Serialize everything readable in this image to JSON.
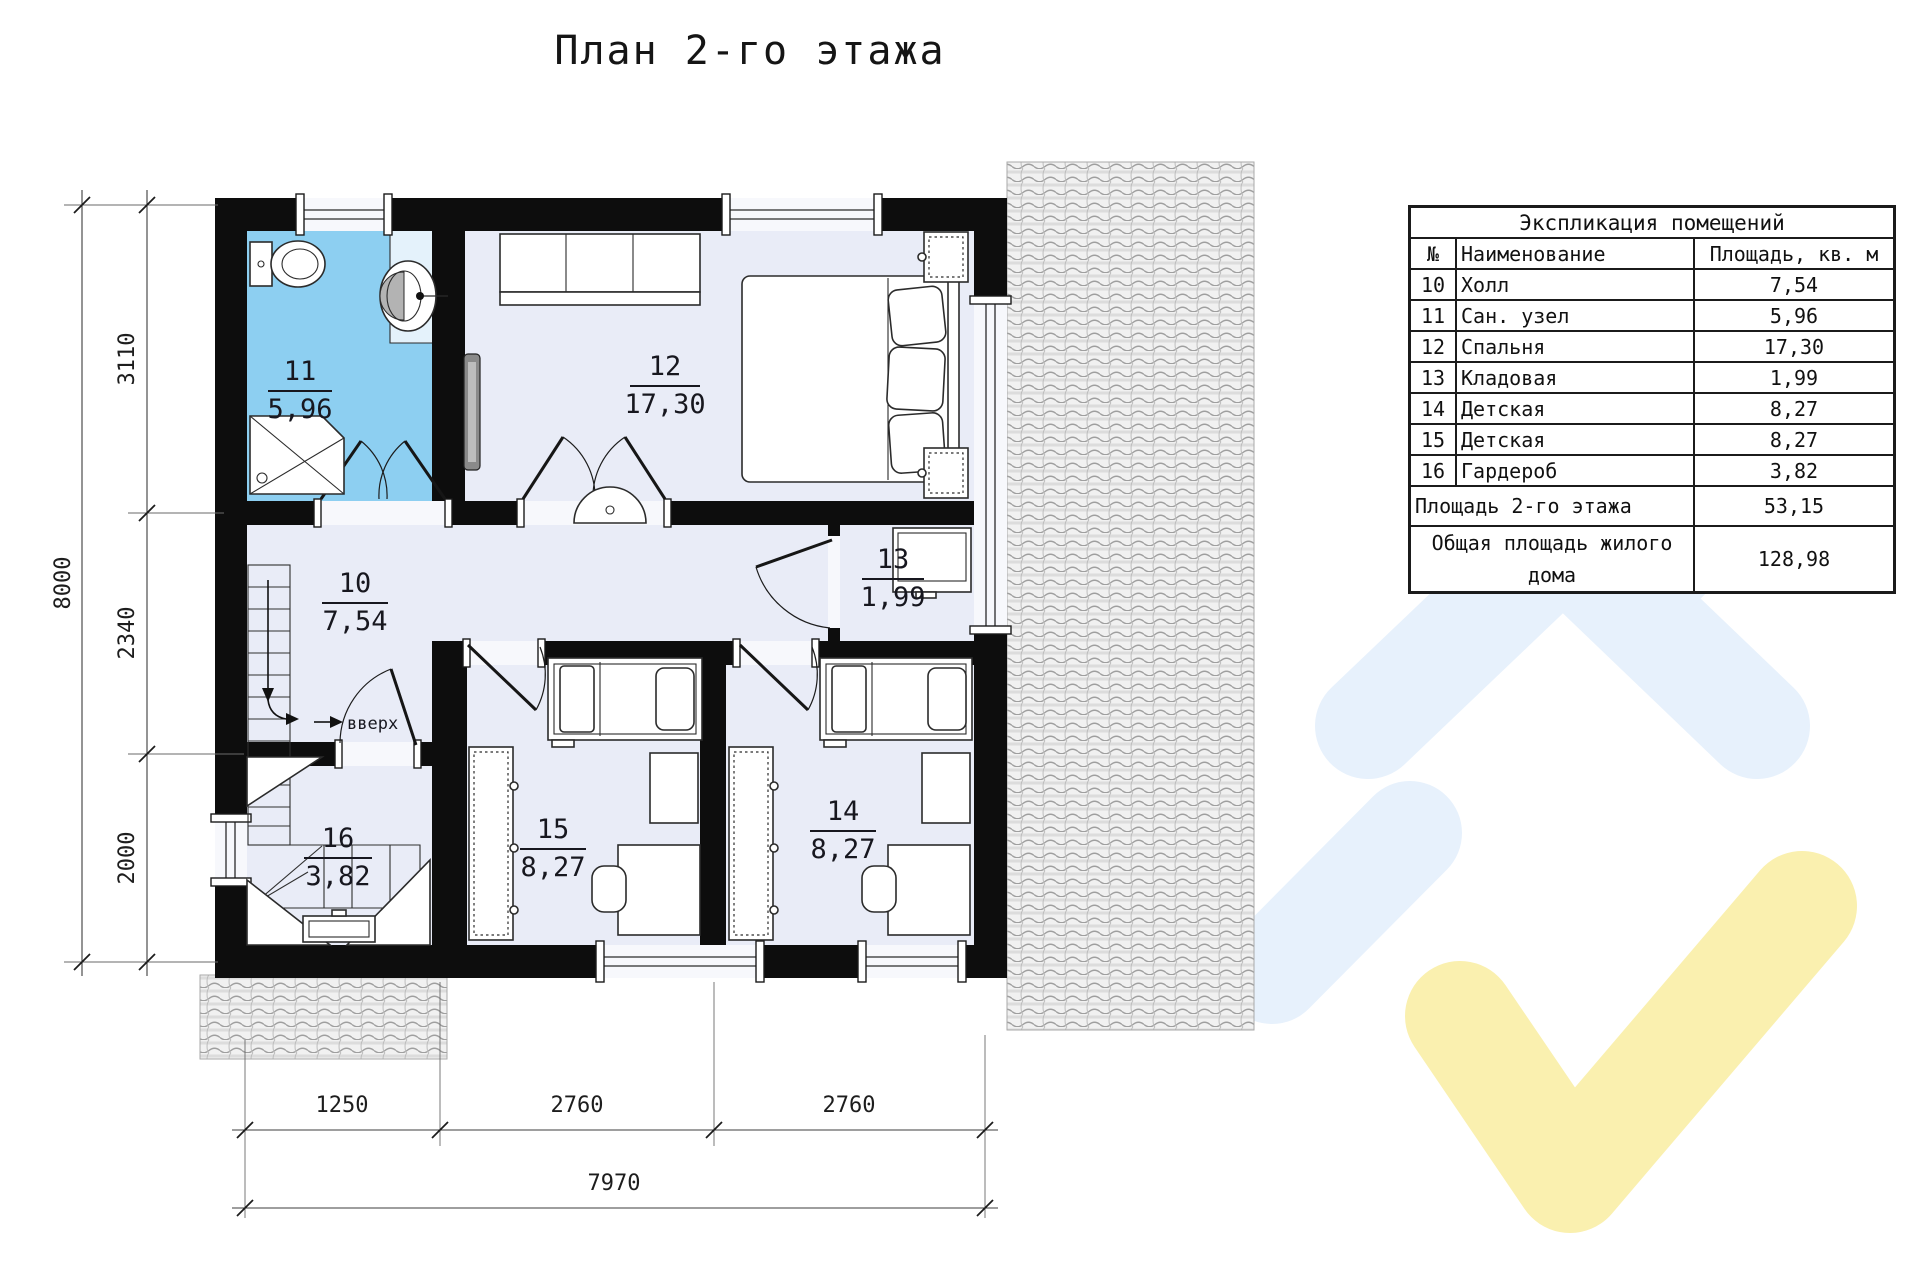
{
  "title": "План 2-го этажа",
  "plan": {
    "stairs_label": "вверх",
    "rooms": {
      "r10": {
        "num": "10",
        "area": "7,54"
      },
      "r11": {
        "num": "11",
        "area": "5,96"
      },
      "r12": {
        "num": "12",
        "area": "17,30"
      },
      "r13": {
        "num": "13",
        "area": "1,99"
      },
      "r14": {
        "num": "14",
        "area": "8,27"
      },
      "r15": {
        "num": "15",
        "area": "8,27"
      },
      "r16": {
        "num": "16",
        "area": "3,82"
      }
    }
  },
  "dimensions": {
    "left_total": "8000",
    "left_segments": [
      "3110",
      "2340",
      "2000"
    ],
    "bottom_segments": [
      "1250",
      "2760",
      "2760"
    ],
    "bottom_total": "7970"
  },
  "legend": {
    "title": "Экспликация помещений",
    "col_num": "№",
    "col_name": "Наименование",
    "col_area": "Площадь, кв. м",
    "rows": [
      {
        "num": "10",
        "name": "Холл",
        "area": "7,54"
      },
      {
        "num": "11",
        "name": "Сан. узел",
        "area": "5,96"
      },
      {
        "num": "12",
        "name": "Спальня",
        "area": "17,30"
      },
      {
        "num": "13",
        "name": "Кладовая",
        "area": "1,99"
      },
      {
        "num": "14",
        "name": "Детская",
        "area": "8,27"
      },
      {
        "num": "15",
        "name": "Детская",
        "area": "8,27"
      },
      {
        "num": "16",
        "name": "Гардероб",
        "area": "3,82"
      }
    ],
    "floor_total_label": "Площадь 2-го этажа",
    "floor_total_value": "53,15",
    "house_total_label": "Общая площадь жилого дома",
    "house_total_value": "128,98"
  },
  "colors": {
    "wall": "#0d0d0d",
    "floor_fill": "#e9ecf7",
    "bathroom_fill": "#8dcff1",
    "roof_tile_base": "#f1f1f1",
    "watermark_blue": "#e7f1fc",
    "watermark_yellow": "#faf0af"
  }
}
